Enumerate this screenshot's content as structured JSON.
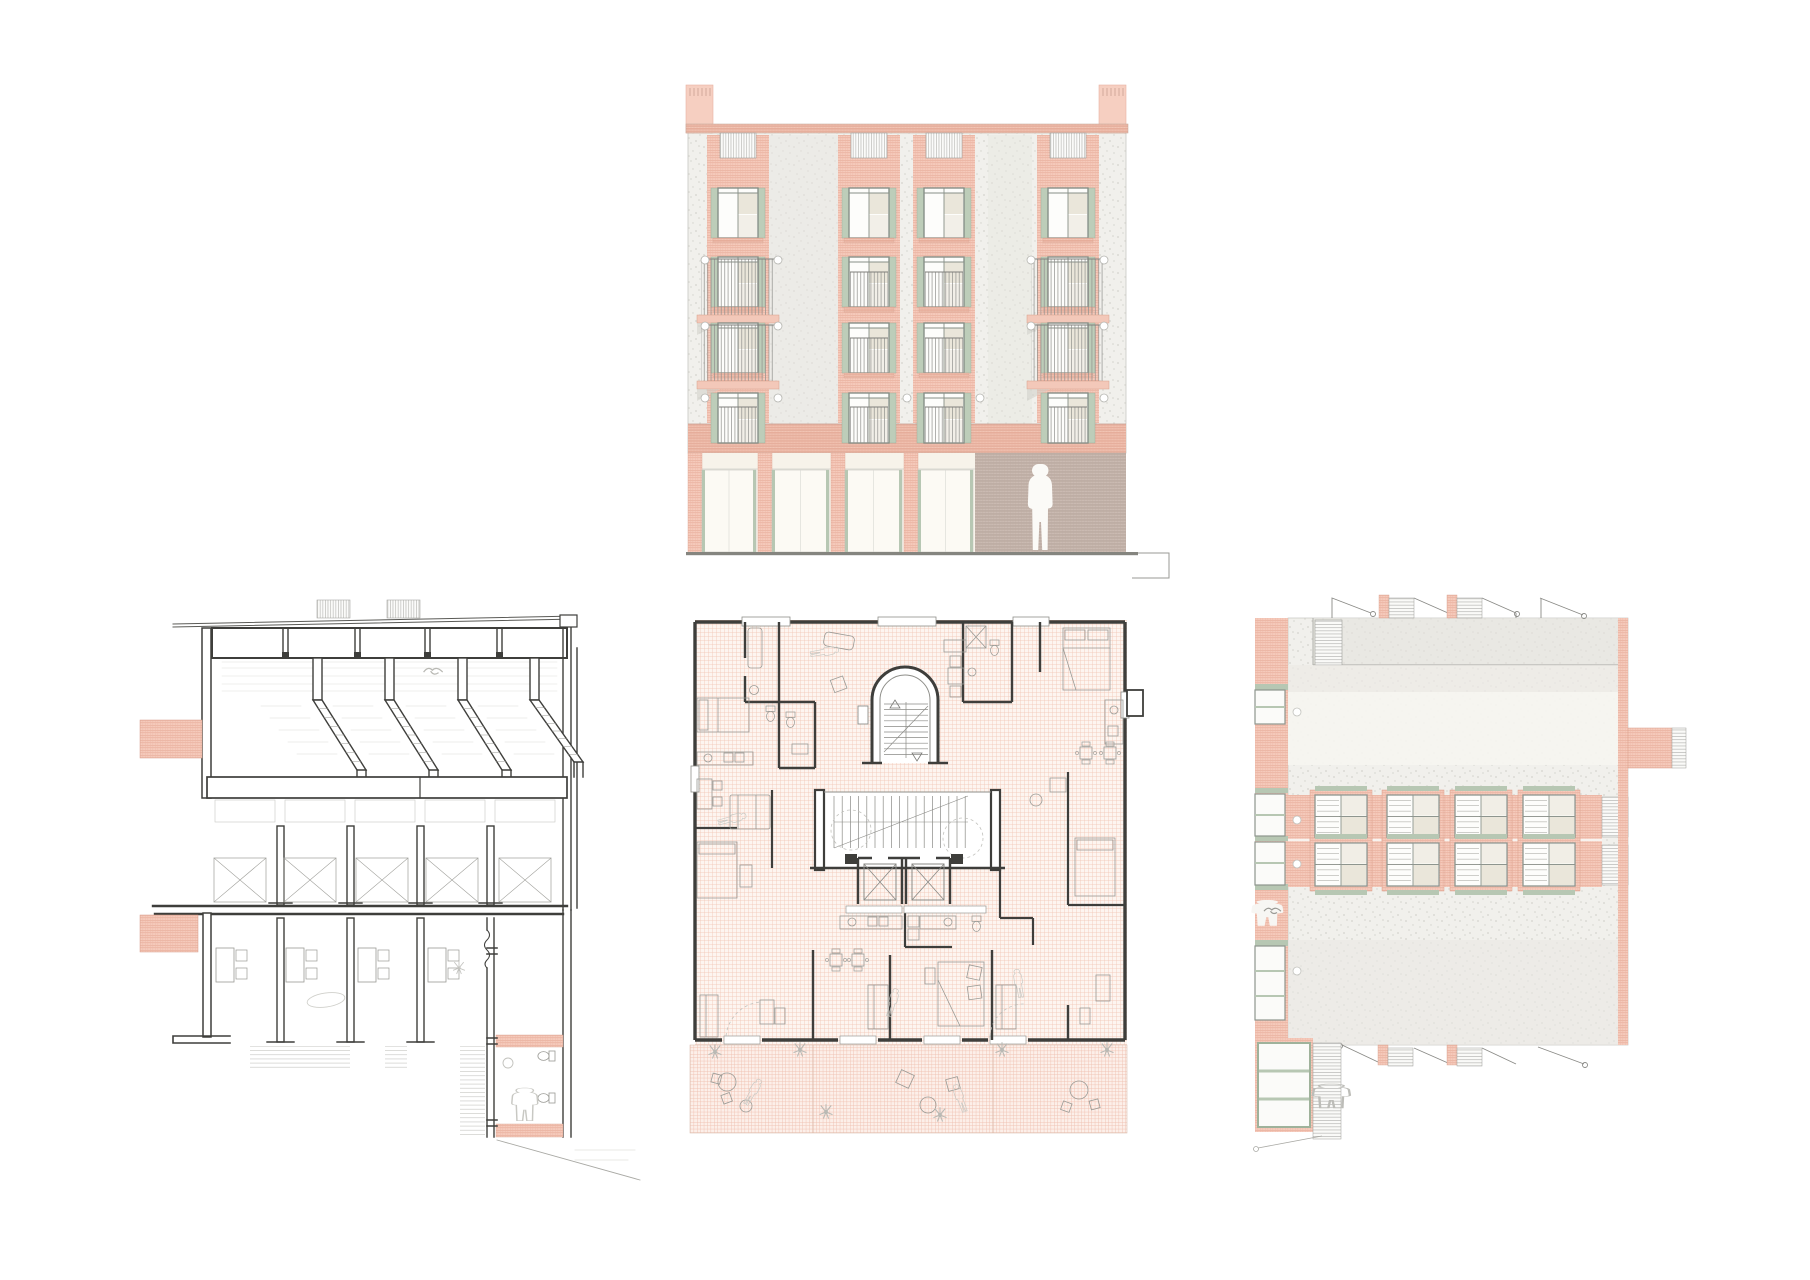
{
  "sheet": {
    "width": 1810,
    "height": 1280,
    "background": "#ffffff",
    "drawing_count": 4
  },
  "palette": {
    "brick_pink": "#f5cabb",
    "brick_line": "#e4a692",
    "band_pink": "#f3c6b6",
    "render_grey": "#f1f0ec",
    "speckle_grey": "#d4d3cd",
    "trim_green": "#b7c7b3",
    "frame_grey": "#8e958e",
    "wall_dark": "#3e3e3b",
    "detail_grey": "#9a9a95",
    "tile_line_pink": "#f0c5b4",
    "tile_bg": "#fdf5f0",
    "terrace_line": "#eebdac",
    "mauve_brick": "#ccbcb3",
    "ghost_grey": "#c6c6c1",
    "glass_shade": "#eae6da"
  },
  "drawings": {
    "front_elevation": {
      "floors": 4,
      "window_columns": [
        738,
        869,
        944,
        1068
      ],
      "window_rows": [
        188,
        257,
        323,
        393
      ],
      "window_width": 40,
      "window_height": 50,
      "balcony_columns": [
        0,
        3
      ],
      "juliet_columns": [
        1,
        2
      ],
      "balcony_rows": [
        1,
        2
      ],
      "chimney_x": [
        686,
        1099
      ],
      "facade_circles": [
        [
          705,
          260
        ],
        [
          778,
          260
        ],
        [
          705,
          326
        ],
        [
          778,
          326
        ],
        [
          1031,
          260
        ],
        [
          1104,
          260
        ],
        [
          1031,
          326
        ],
        [
          1104,
          326
        ],
        [
          705,
          398
        ],
        [
          778,
          398
        ],
        [
          907,
          398
        ],
        [
          980,
          398
        ],
        [
          1104,
          398
        ]
      ],
      "storefront_piers": [
        688,
        758,
        831,
        904
      ],
      "storefront_bays": [
        [
          702,
          756
        ],
        [
          772,
          829
        ],
        [
          845,
          902
        ],
        [
          918,
          973
        ]
      ]
    },
    "staircase_plan": {
      "stair_heads": [
        313,
        385,
        458,
        530
      ],
      "cell_dividers": [
        283,
        355,
        425,
        497
      ],
      "room_partitions_upper": [
        277,
        347,
        417,
        487
      ],
      "room_partitions_lower": [
        277,
        347,
        417
      ],
      "bed_centers": [
        240,
        310,
        382,
        452,
        525
      ],
      "desk_rooms": [
        240,
        310,
        382,
        452
      ]
    },
    "typical_floor_plan": {
      "arch_center_x": 905,
      "arch_stair_treads": 10,
      "courtyard_stair_treads": 17,
      "terrace_dividers": [
        813,
        993
      ],
      "tables_four_chairs": [
        [
          1086,
          753
        ],
        [
          1110,
          753
        ],
        [
          836,
          960
        ],
        [
          858,
          960
        ]
      ],
      "plants": [
        [
          800,
          1050
        ],
        [
          826,
          1112
        ],
        [
          1002,
          1050
        ],
        [
          1107,
          1050
        ],
        [
          940,
          1115
        ],
        [
          715,
          1052
        ]
      ],
      "people": [
        [
          893,
          988,
          15
        ],
        [
          1013,
          970,
          -10
        ],
        [
          757,
          1078,
          30
        ],
        [
          952,
          1086,
          -20
        ],
        [
          838,
          646,
          80
        ],
        [
          745,
          812,
          75
        ]
      ]
    },
    "roof_plan": {
      "window_columns": [
        1315,
        1387,
        1455,
        1523
      ],
      "window_rows": [
        795,
        843
      ],
      "window_width": 52,
      "window_height": 43,
      "edge_circles": [
        [
          1297,
          712
        ],
        [
          1297,
          820
        ],
        [
          1297,
          864
        ],
        [
          1297,
          971
        ]
      ]
    }
  }
}
